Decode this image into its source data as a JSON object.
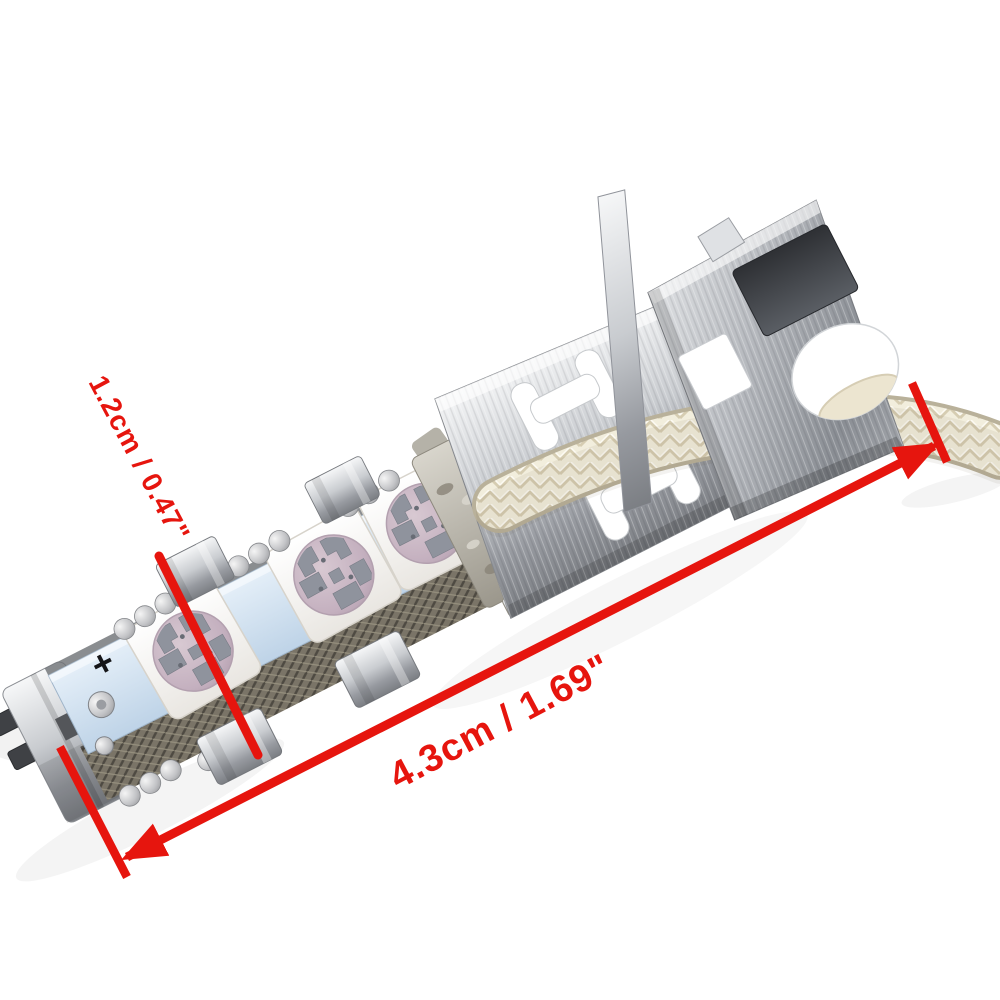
{
  "scene": {
    "subject": "H3 LED car bulb with 5050 SMD chips and metal mounting bracket",
    "background": "#ffffff"
  },
  "annotations": {
    "color": "#e6150e",
    "width": {
      "label": "1.2cm / 0.47\""
    },
    "length": {
      "label": "4.3cm / 1.69\""
    }
  },
  "markings": {
    "positive": "+",
    "negative": "−"
  },
  "palette": {
    "pcb": "#cfe0f0",
    "chip_body": "#f8f7f3",
    "led_lens": "#cbb7c4",
    "electrode": "#8f939d",
    "metal_light": "#f1f2f4",
    "metal_mid": "#b7babf",
    "metal_dark": "#7b7e83",
    "knurl": "#7a7467",
    "wire_braid": "#f2eedd",
    "solder_collar": "#b4b0a5"
  }
}
